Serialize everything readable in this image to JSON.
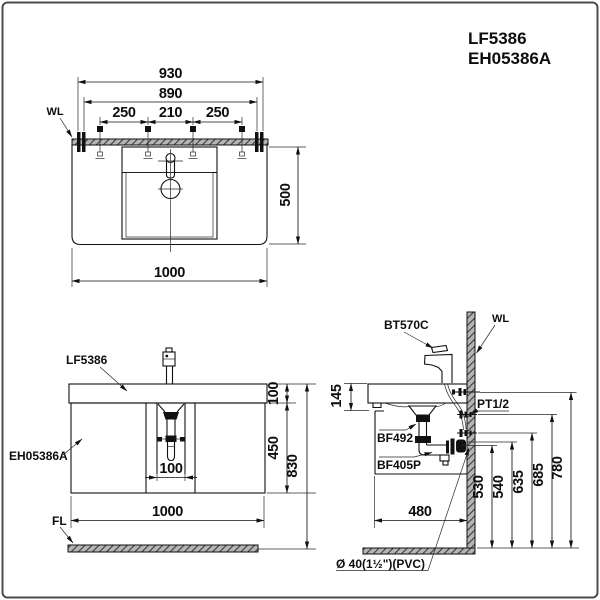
{
  "header": {
    "model_1": "LF5386",
    "model_2": "EH05386A"
  },
  "plan_view": {
    "wall_label": "WL",
    "dim_930": "930",
    "dim_890": "890",
    "dim_250_left": "250",
    "dim_210": "210",
    "dim_250_right": "250",
    "dim_500": "500",
    "dim_1000": "1000"
  },
  "front_view": {
    "counter_label": "LF5386",
    "cabinet_label": "EH05386A",
    "floor_label": "FL",
    "dim_100_counter": "100",
    "dim_450": "450",
    "dim_830": "830",
    "dim_100_drain": "100",
    "dim_1000": "1000"
  },
  "side_view": {
    "faucet_label": "BT570C",
    "wall_label": "WL",
    "supply_label": "PT1/2",
    "drain_label": "BF492",
    "trap_label": "BF405P",
    "pipe_label": "Ø 40(1½\")(PVC)",
    "dim_145": "145",
    "dim_480": "480",
    "dim_530": "530",
    "dim_540": "540",
    "dim_635": "635",
    "dim_685": "685",
    "dim_780": "780"
  }
}
